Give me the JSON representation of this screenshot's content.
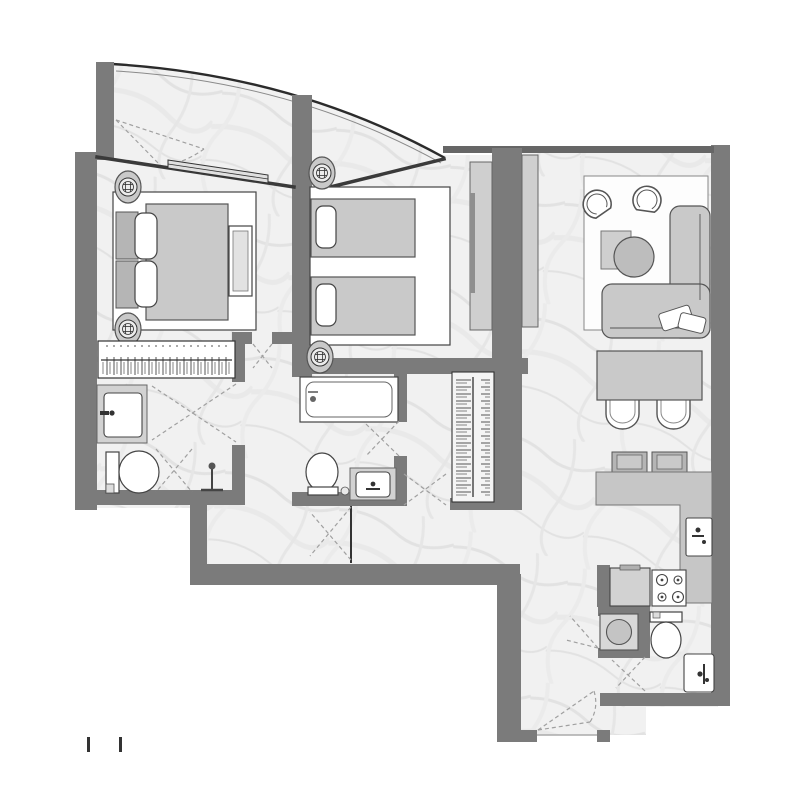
{
  "meta": {
    "title": "Two-bedroom apartment floor plan with curved balcony",
    "type": "architectural-floor-plan",
    "orientation": "top-down"
  },
  "colors": {
    "wall": "#7b7b7b",
    "furniture_fill": "#c9c9c9",
    "fixture_fill": "#ffffff",
    "outline": "#444444",
    "floor_marble": "#f1f1f1",
    "door_swing_dash": "#a0a0a0"
  },
  "rooms": [
    {
      "id": "balcony",
      "label": "curved balcony",
      "features": [
        "curved glass railing",
        "partition wall",
        "sliding door",
        "door swing"
      ]
    },
    {
      "id": "bedroom-1",
      "label": "master bedroom",
      "furniture": [
        "double bed",
        "headboard cushions",
        "two pillows",
        "two bedside lamps",
        "foot bench",
        "built-in wardrobe with hanging clothes"
      ]
    },
    {
      "id": "bedroom-2",
      "label": "second bedroom",
      "furniture": [
        "twin bed 1",
        "twin bed 2",
        "two pillows",
        "two bedside lamps",
        "wardrobe cabinet"
      ]
    },
    {
      "id": "master-bathroom",
      "label": "master bathroom / dressing",
      "furniture": [
        "vanity sink",
        "toilet",
        "shower head",
        "door swings"
      ]
    },
    {
      "id": "bathroom-2",
      "label": "second bathroom",
      "furniture": [
        "bathtub",
        "toilet",
        "vanity sink"
      ]
    },
    {
      "id": "hall-closet",
      "label": "hall closet",
      "furniture": [
        "hanging rail with clothes"
      ]
    },
    {
      "id": "living-room",
      "label": "living room",
      "furniture": [
        "armchair 1",
        "armchair 2",
        "corner sofa",
        "throw pillows",
        "round coffee table",
        "side table",
        "tv console bedroom side",
        "tv console living side",
        "area rug"
      ]
    },
    {
      "id": "dining-area",
      "label": "dining area",
      "furniture": [
        "dining table",
        "dining chair 1",
        "dining chair 2"
      ]
    },
    {
      "id": "kitchen",
      "label": "kitchen",
      "furniture": [
        "breakfast bar counter",
        "bar stool 1",
        "bar stool 2",
        "kitchen sink",
        "cooktop with 4 burners",
        "refrigerator"
      ]
    },
    {
      "id": "guest-bathroom",
      "label": "guest bathroom",
      "furniture": [
        "washing machine",
        "toilet",
        "sink"
      ]
    },
    {
      "id": "entry",
      "label": "entrance corridor",
      "features": [
        "entry door opening",
        "door swing"
      ]
    }
  ],
  "annotations": {
    "scale_marks_count": 2
  }
}
